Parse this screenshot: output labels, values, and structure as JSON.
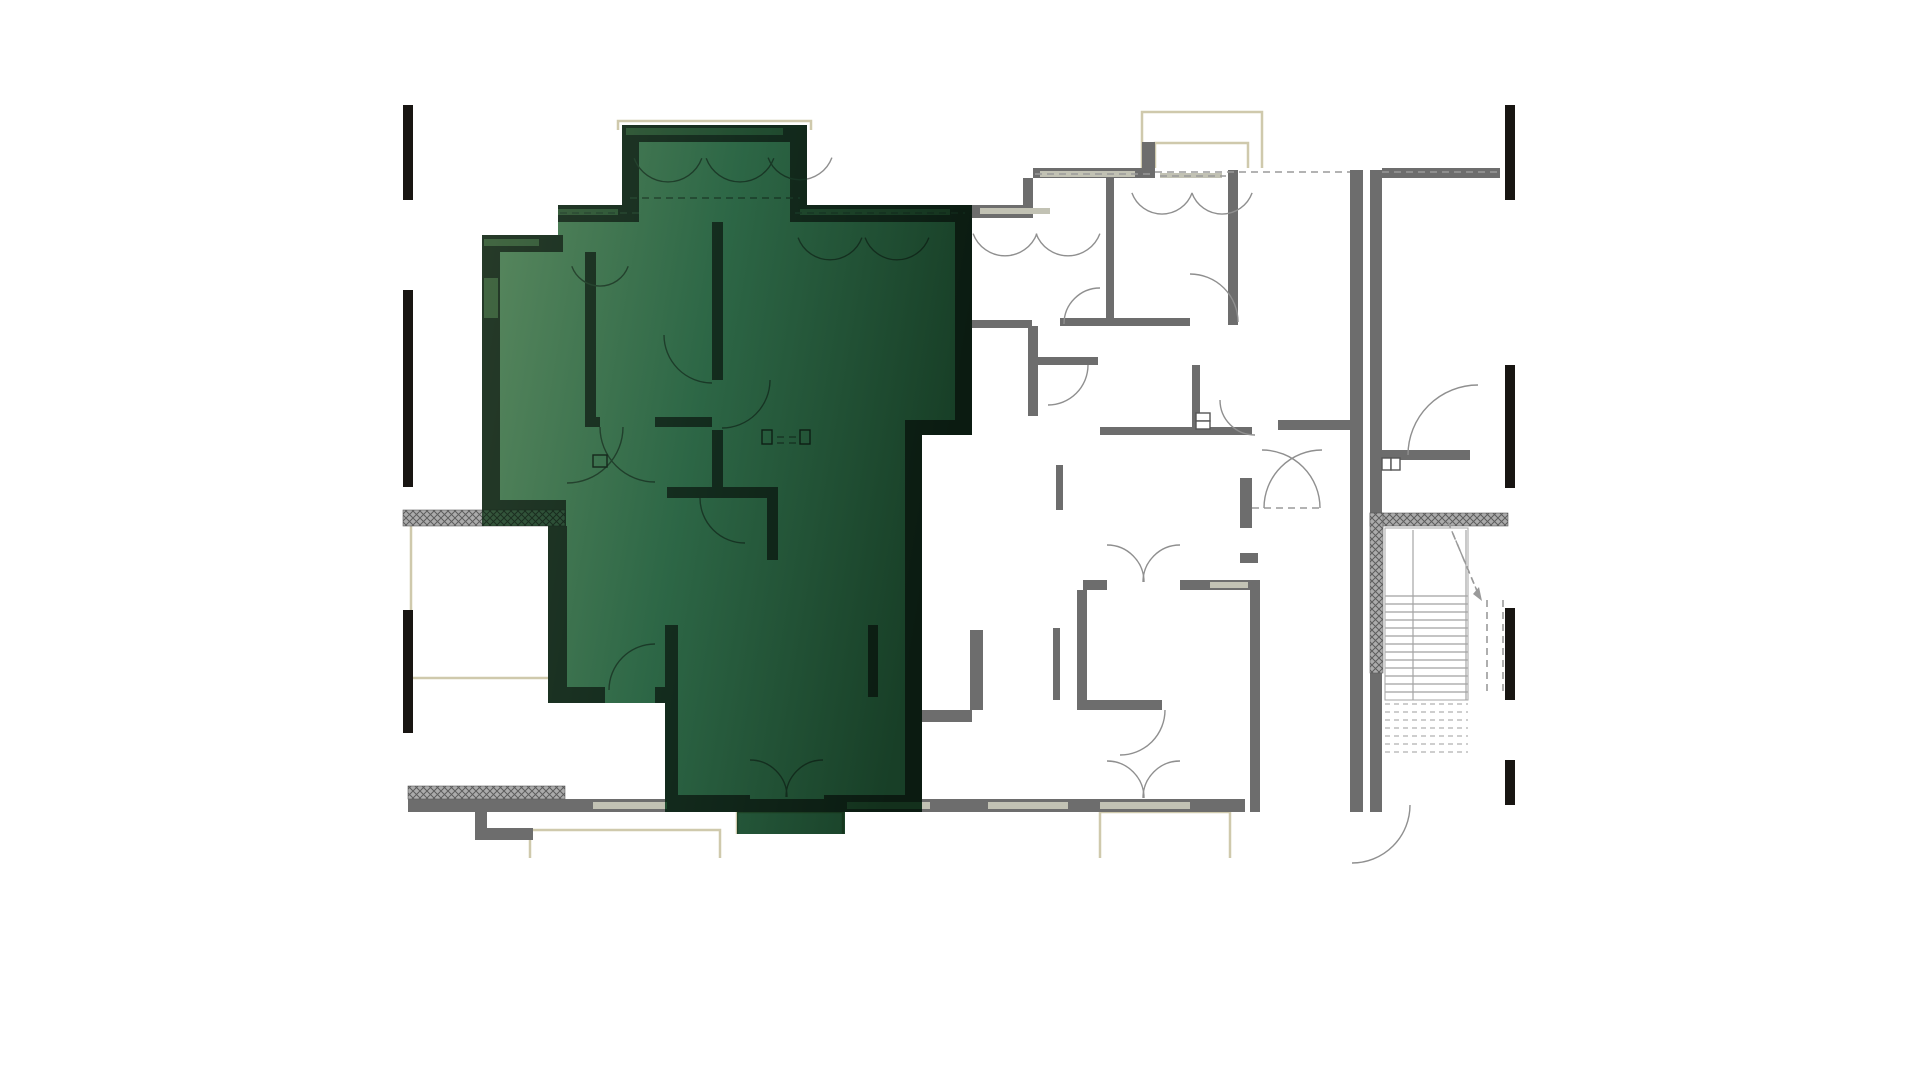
{
  "page": {
    "background": "#ffffff",
    "description": "architectural-floor-plan-with-highlighted-unit"
  },
  "colors": {
    "wall": "#6d6d6d",
    "wall_dark": "#565656",
    "arc_stroke": "#8f8f8f",
    "thin_stroke": "#a5a5a5",
    "beige": "#cfc9ac",
    "dash": "#9a9a9a",
    "sill": "#c2c2b4",
    "black_mark": "#181512",
    "tread": "#b0b0b0",
    "hatch_bg": "#ababab",
    "hatch_line": "#5d5d5d",
    "green_light": "#5c8a60",
    "green_mid": "#2d6746",
    "green_dark": "#183f27"
  },
  "plan": {
    "viewport": {
      "width": 1920,
      "height": 1080
    },
    "highlight_unit": {
      "points": "558,205 622,205 622,125 807,125 807,205 972,205 972,435 922,435 922,812 845,812 845,834 737,834 737,812 665,812 665,703 548,703 548,526 482,526 482,235 558,235",
      "gradient": [
        "#5c8a60",
        "#2d6746",
        "#183f27"
      ]
    },
    "walls": [
      [
        558,
        205,
        81,
        17
      ],
      [
        790,
        205,
        182,
        17
      ],
      [
        622,
        125,
        17,
        97
      ],
      [
        790,
        125,
        17,
        97
      ],
      [
        622,
        125,
        185,
        17
      ],
      [
        482,
        235,
        81,
        17
      ],
      [
        482,
        252,
        18,
        274
      ],
      [
        482,
        500,
        84,
        26
      ],
      [
        548,
        526,
        19,
        161
      ],
      [
        548,
        687,
        57,
        16
      ],
      [
        655,
        687,
        23,
        16
      ],
      [
        665,
        625,
        13,
        187
      ],
      [
        665,
        795,
        85,
        17
      ],
      [
        824,
        795,
        81,
        17
      ],
      [
        905,
        420,
        17,
        392
      ],
      [
        905,
        420,
        67,
        15
      ],
      [
        955,
        205,
        17,
        230
      ],
      [
        712,
        222,
        11,
        158
      ],
      [
        712,
        430,
        11,
        57
      ],
      [
        585,
        252,
        11,
        175
      ],
      [
        585,
        417,
        15,
        10
      ],
      [
        655,
        417,
        57,
        10
      ],
      [
        667,
        487,
        110,
        11
      ],
      [
        767,
        487,
        11,
        73
      ],
      [
        868,
        625,
        10,
        72
      ],
      [
        906,
        710,
        66,
        12
      ],
      [
        972,
        205,
        61,
        13
      ],
      [
        1023,
        178,
        10,
        40
      ],
      [
        1033,
        168,
        122,
        10
      ],
      [
        1142,
        142,
        13,
        30
      ],
      [
        1106,
        178,
        8,
        142
      ],
      [
        1228,
        170,
        10,
        155
      ],
      [
        1060,
        318,
        130,
        8
      ],
      [
        972,
        320,
        60,
        8
      ],
      [
        1028,
        326,
        10,
        90
      ],
      [
        1038,
        357,
        60,
        8
      ],
      [
        1192,
        365,
        8,
        70
      ],
      [
        1100,
        427,
        152,
        8
      ],
      [
        1056,
        465,
        7,
        45
      ],
      [
        1083,
        580,
        24,
        10
      ],
      [
        1180,
        580,
        70,
        10
      ],
      [
        1250,
        580,
        10,
        232
      ],
      [
        1077,
        590,
        10,
        115
      ],
      [
        1077,
        700,
        85,
        10
      ],
      [
        970,
        630,
        13,
        80
      ],
      [
        1053,
        628,
        7,
        72
      ],
      [
        1350,
        170,
        13,
        642
      ],
      [
        1370,
        170,
        12,
        642
      ],
      [
        1278,
        420,
        75,
        10
      ],
      [
        1240,
        478,
        12,
        50
      ],
      [
        1240,
        553,
        18,
        10
      ],
      [
        1250,
        623,
        10,
        40
      ],
      [
        1382,
        450,
        88,
        10
      ],
      [
        1382,
        168,
        118,
        10
      ],
      [
        515,
        799,
        78,
        13
      ],
      [
        475,
        812,
        12,
        28
      ],
      [
        475,
        828,
        58,
        12
      ],
      [
        563,
        799,
        682,
        13
      ],
      [
        408,
        798,
        157,
        14
      ]
    ],
    "window_bands": [
      [
        626,
        128,
        157,
        7
      ],
      [
        558,
        209,
        60,
        6
      ],
      [
        800,
        209,
        150,
        6
      ],
      [
        484,
        239,
        55,
        7
      ],
      [
        484,
        278,
        14,
        40
      ],
      [
        980,
        208,
        70,
        6
      ],
      [
        1040,
        171,
        95,
        6
      ],
      [
        1160,
        173,
        62,
        5
      ],
      [
        1210,
        582,
        38,
        6
      ],
      [
        593,
        802,
        74,
        7
      ],
      [
        847,
        802,
        83,
        7
      ],
      [
        988,
        802,
        80,
        7
      ],
      [
        1100,
        802,
        90,
        7
      ]
    ],
    "hatched": [
      [
        403,
        510,
        80,
        16
      ],
      [
        483,
        510,
        82,
        16
      ],
      [
        408,
        786,
        157,
        13
      ],
      [
        1370,
        513,
        138,
        13
      ],
      [
        1370,
        513,
        13,
        160
      ]
    ],
    "black_marks": [
      [
        403,
        105,
        10,
        95
      ],
      [
        403,
        290,
        10,
        197
      ],
      [
        403,
        610,
        10,
        123
      ],
      [
        1505,
        105,
        10,
        95
      ],
      [
        1505,
        365,
        10,
        123
      ],
      [
        1505,
        608,
        10,
        92
      ],
      [
        1505,
        760,
        10,
        45
      ]
    ],
    "door_arcs": [
      [
        668,
        146,
        36,
        20,
        160
      ],
      [
        740,
        146,
        36,
        20,
        160
      ],
      [
        800,
        146,
        34,
        20,
        160
      ],
      [
        830,
        226,
        34,
        20,
        160
      ],
      [
        897,
        226,
        34,
        20,
        160
      ],
      [
        600,
        256,
        30,
        20,
        160
      ],
      [
        1005,
        222,
        34,
        20,
        160
      ],
      [
        1068,
        222,
        34,
        20,
        160
      ],
      [
        1162,
        182,
        32,
        20,
        160
      ],
      [
        1222,
        182,
        32,
        20,
        160
      ],
      [
        722,
        380,
        48,
        0,
        90
      ],
      [
        712,
        335,
        48,
        90,
        180
      ],
      [
        655,
        427,
        55,
        90,
        180
      ],
      [
        567,
        427,
        56,
        0,
        90
      ],
      [
        745,
        498,
        45,
        90,
        180
      ],
      [
        655,
        690,
        46,
        180,
        270
      ],
      [
        1100,
        324,
        36,
        180,
        270
      ],
      [
        1048,
        365,
        40,
        0,
        90
      ],
      [
        1255,
        400,
        35,
        90,
        180
      ],
      [
        1190,
        322,
        48,
        270,
        360
      ],
      [
        1478,
        455,
        70,
        180,
        270
      ],
      [
        1262,
        508,
        58,
        270,
        360
      ],
      [
        1322,
        508,
        58,
        180,
        270
      ],
      [
        1120,
        710,
        45,
        0,
        90
      ],
      [
        1352,
        805,
        58,
        0,
        90
      ],
      [
        1107,
        582,
        37,
        270,
        360
      ],
      [
        1180,
        582,
        37,
        180,
        270
      ],
      [
        750,
        797,
        37,
        270,
        360
      ],
      [
        823,
        797,
        37,
        180,
        270
      ],
      [
        1107,
        798,
        37,
        270,
        360
      ],
      [
        1180,
        798,
        37,
        180,
        270
      ]
    ],
    "dashed_lines": [
      [
        630,
        198,
        800,
        198
      ],
      [
        560,
        213,
        640,
        213
      ],
      [
        795,
        213,
        965,
        213
      ],
      [
        1035,
        174,
        1150,
        174
      ],
      [
        1160,
        176,
        1226,
        176
      ],
      [
        1155,
        172,
        1350,
        172
      ],
      [
        1382,
        172,
        1498,
        172
      ],
      [
        1252,
        508,
        1322,
        508
      ],
      [
        765,
        437,
        810,
        437
      ],
      [
        765,
        443,
        810,
        443
      ],
      [
        1448,
        522,
        1480,
        598
      ],
      [
        1487,
        600,
        1487,
        695
      ],
      [
        1503,
        600,
        1503,
        695
      ]
    ],
    "beige_outlines": [
      "411,526 411,678 551,678",
      "618,130 618,121 811,121 811,130",
      "1142,168 1142,112 1262,112 1262,168",
      "1155,168 1155,143 1248,143 1248,168",
      "530,858 530,830 720,830 720,858",
      "737,834 737,812 843,812 843,834",
      "1100,858 1100,812 1230,812 1230,858"
    ],
    "stairs": {
      "tread_x1": 1385,
      "tread_x2": 1468,
      "tread_y0": 596,
      "tread_step": 8,
      "tread_count": 13,
      "dashed_tread_y0": 704,
      "dashed_tread_count": 7,
      "rails": [
        [
          1413,
          530,
          1413,
          700
        ],
        [
          1466,
          530,
          1466,
          700
        ]
      ],
      "outline": [
        1385,
        528,
        83,
        172
      ],
      "arrow_head": "1482,601 1473,594 1479,587"
    },
    "fixtures": [
      [
        1196,
        413,
        14,
        8
      ],
      [
        1196,
        421,
        14,
        8
      ],
      [
        1382,
        458,
        9,
        12
      ],
      [
        1391,
        458,
        9,
        12
      ],
      [
        762,
        430,
        10,
        14
      ],
      [
        800,
        430,
        10,
        14
      ],
      [
        593,
        455,
        14,
        12
      ]
    ]
  }
}
